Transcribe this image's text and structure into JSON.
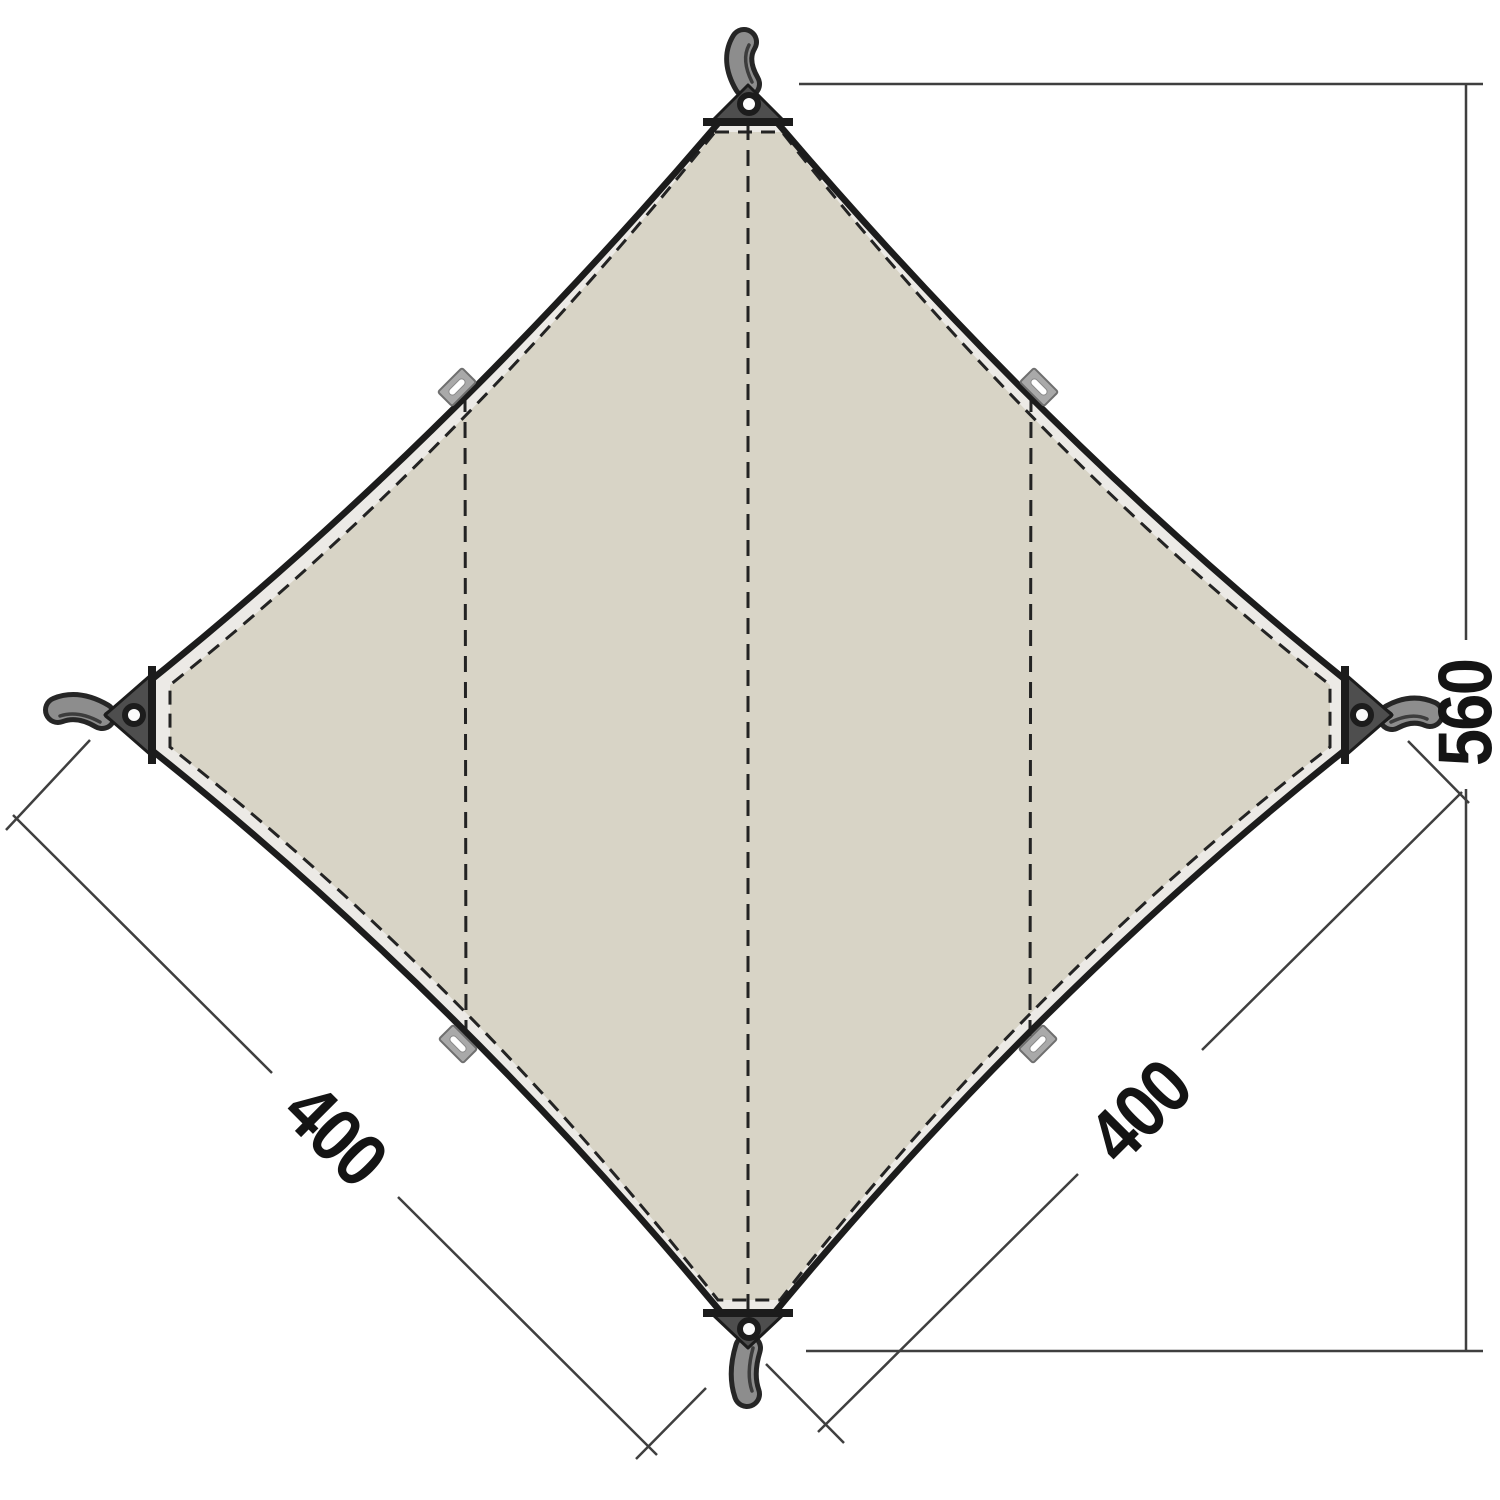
{
  "colors": {
    "background": "#ffffff",
    "fabric": "#d8d4c6",
    "hem-band": "#eceae6",
    "outline": "#1c1c1c",
    "corner-patch": "#4e4e4e",
    "webbing": "#8d8d8d",
    "tab": "#a9a9a9",
    "stitch": "#232323",
    "dimension-line": "#3f3f3f",
    "label-text": "#141414"
  },
  "dimensions": {
    "diagonal": "560",
    "left-edge": "400",
    "right-edge": "400"
  }
}
